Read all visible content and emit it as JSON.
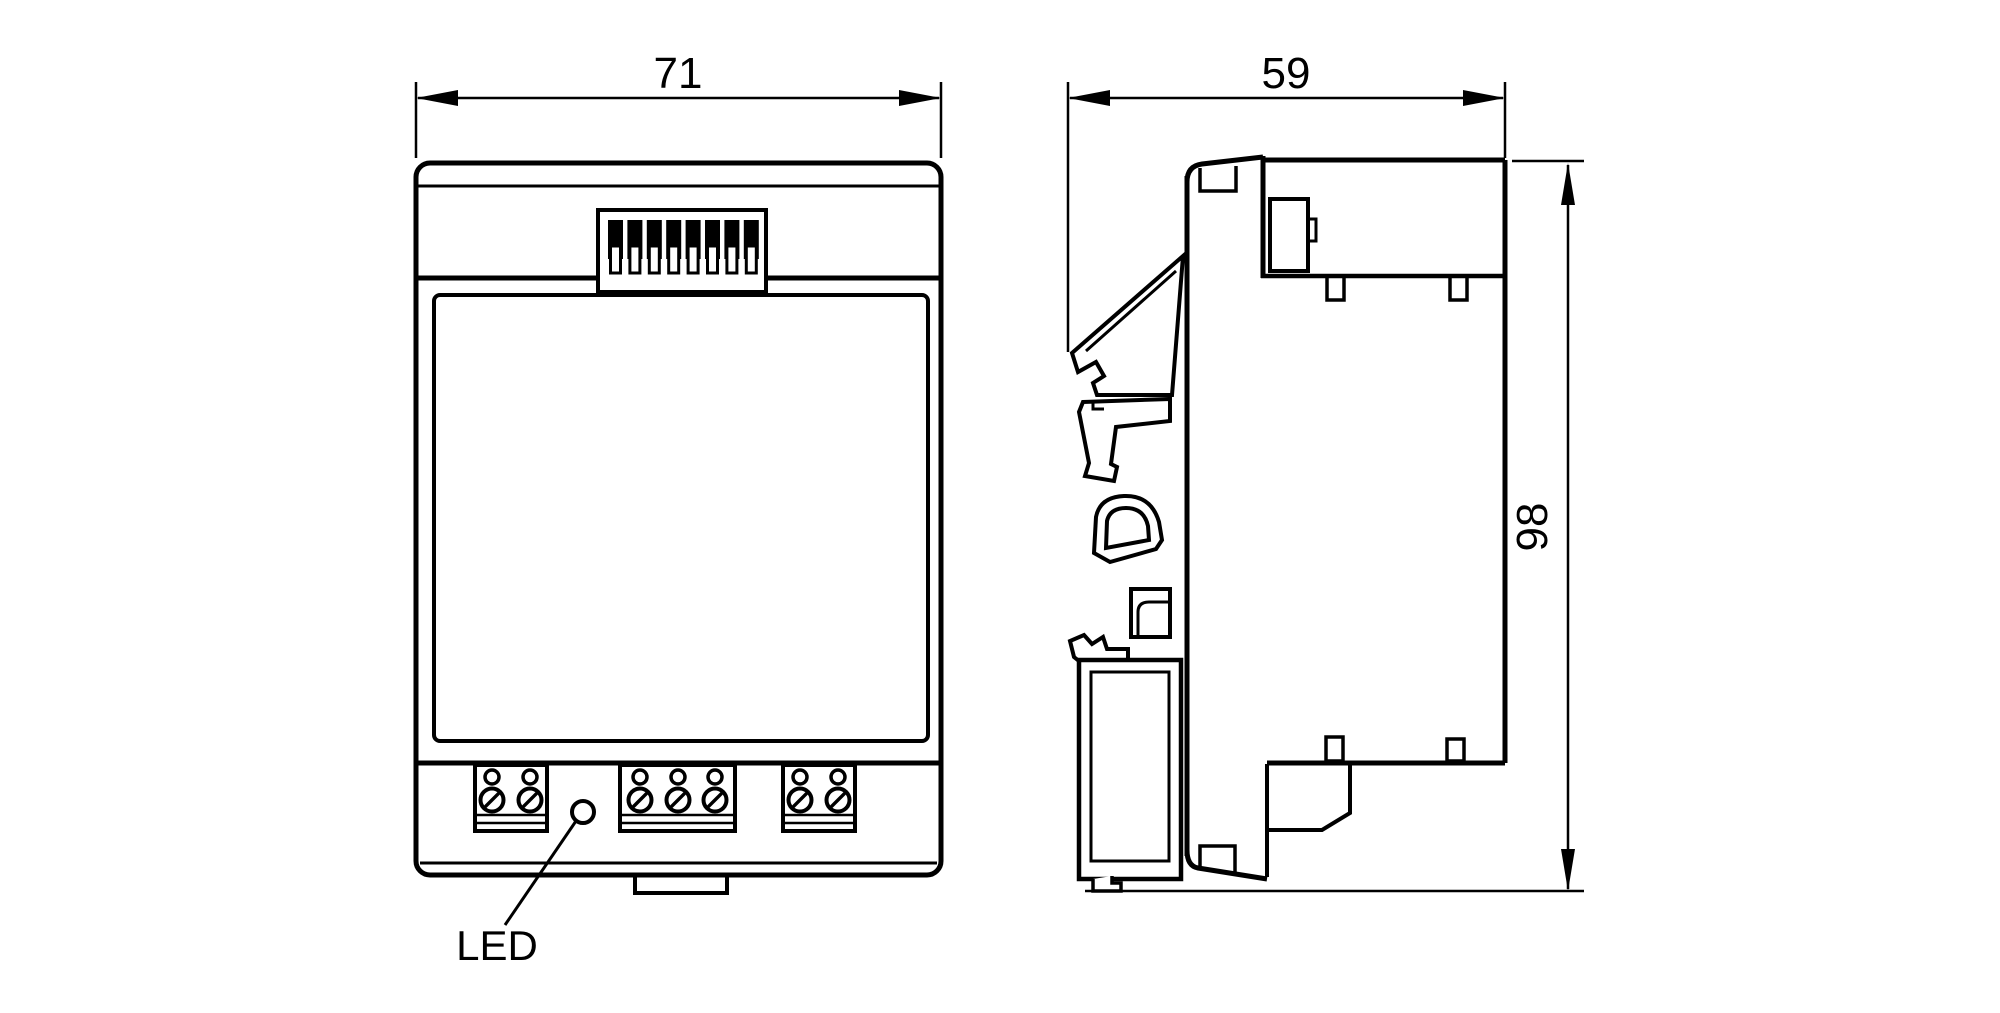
{
  "drawing": {
    "front_view": {
      "width_dim": "71",
      "led_label": "LED",
      "dip_switch_count": 8,
      "terminal_groups": [
        2,
        3,
        2
      ]
    },
    "side_view": {
      "depth_dim": "59",
      "height_dim": "98"
    },
    "colors": {
      "line": "#000000",
      "background": "#ffffff"
    }
  }
}
